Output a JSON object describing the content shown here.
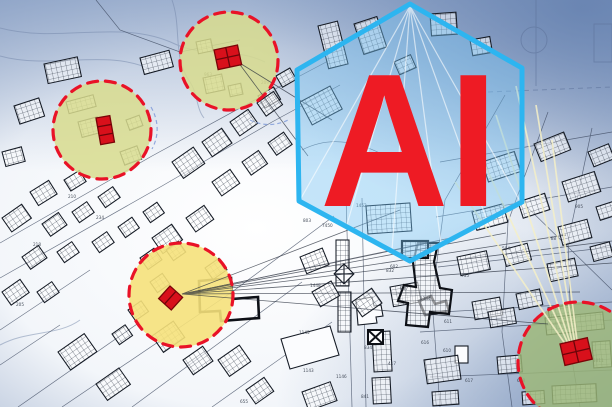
{
  "overlay": {
    "ai_label": "AI"
  },
  "palette": {
    "ai_text": "#ee1b24",
    "hexagon_stroke": "#2db5f0",
    "hexagon_fill": "rgba(118,195,242,0.42)",
    "hotspot_ring": "#e91227",
    "red_building": "#d8101b",
    "map_line": "#39455c",
    "background_edge": "#93a6c6"
  },
  "hotspots": [
    {
      "name": "zone-left",
      "fill": "#d8dc8e"
    },
    {
      "name": "zone-top",
      "fill": "#d8dc8e"
    },
    {
      "name": "zone-bottom-center",
      "fill": "#f5e17b"
    },
    {
      "name": "zone-bottom-right",
      "fill": "#9db877"
    }
  ],
  "parcel_numbers": [
    "218",
    "234",
    "210",
    "233",
    "205",
    "963",
    "209",
    "1452",
    "7450",
    "803",
    "832",
    "837",
    "1448",
    "1145",
    "1143",
    "1146",
    "834",
    "417",
    "841",
    "655",
    "611",
    "610",
    "616",
    "617",
    "628",
    "1011",
    "504",
    "768",
    "755",
    "905",
    "1344",
    "602"
  ]
}
